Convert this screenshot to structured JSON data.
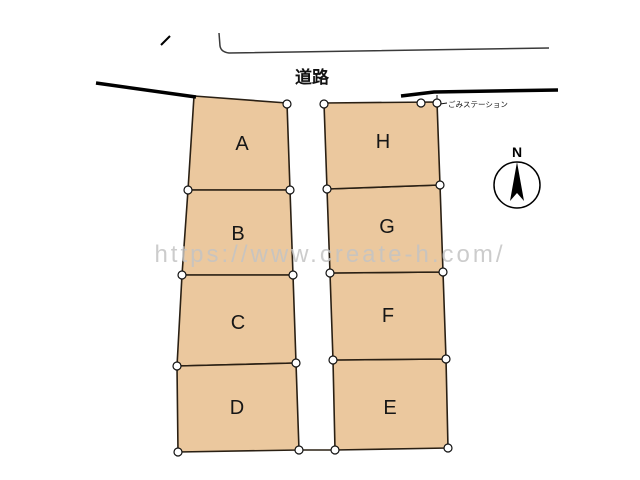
{
  "plan": {
    "road_label": "道路",
    "trash_station_label": "ごみステーション",
    "compass_label": "N",
    "watermark_text": "https://www.create-h.com/",
    "lots": [
      {
        "id": "A",
        "label": "A"
      },
      {
        "id": "B",
        "label": "B"
      },
      {
        "id": "C",
        "label": "C"
      },
      {
        "id": "D",
        "label": "D"
      },
      {
        "id": "E",
        "label": "E"
      },
      {
        "id": "F",
        "label": "F"
      },
      {
        "id": "G",
        "label": "G"
      },
      {
        "id": "H",
        "label": "H"
      }
    ],
    "colors": {
      "lot_fill": "#ebc89e",
      "lot_stroke": "#2a2014",
      "road_line": "#000000",
      "thin_line": "#3a3a3a",
      "watermark": "#c4c4c4",
      "vertex_fill": "#ffffff",
      "vertex_stroke": "#111111"
    }
  }
}
